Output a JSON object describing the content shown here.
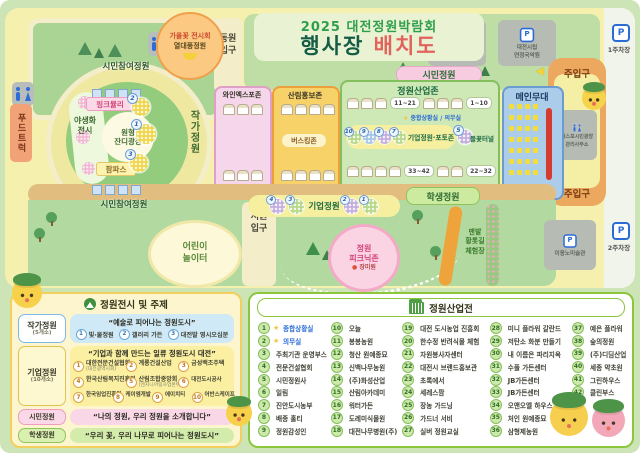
{
  "icons": {
    "parking": "P",
    "star": "★",
    "arrow_left": "◀",
    "dot": "●"
  },
  "title": {
    "line1": "2025 대전정원박람회",
    "line2a": "행사장",
    "line2b": "배치도"
  },
  "badge": {
    "line1": "가을꽃 전시회",
    "line2": "열대풍정원"
  },
  "gates": {
    "east1": "동원",
    "east2": "입구",
    "west1": "서원",
    "west2": "입구"
  },
  "facilities": {
    "arboretum1": "한밭수목원",
    "arboretum2": "종합안내센터",
    "gugak1": "대전시립",
    "gugak2": "연정국악원",
    "office1": "엑스포시민광장",
    "office2": "관리사무소",
    "museum": "이응노미술관",
    "parking1": "1주차장",
    "parking2": "2주차장",
    "food_truck": "푸드트럭"
  },
  "map_labels": {
    "citizen_garden": "시민정원",
    "entrance_top": "주입구",
    "entrance_bottom": "주입구",
    "participation_top": "시민참여정원",
    "participation_bottom": "시민참여정원",
    "pink_muhly": "핑크뮬리",
    "pampas": "팜파스",
    "wildflower1": "야생화",
    "wildflower2": "전시",
    "lawn1": "원형",
    "lawn2": "잔디광장",
    "artist_garden": "작가정원",
    "playground1": "어린이",
    "playground2": "놀이터",
    "corporate_garden": "기업정원",
    "student_garden": "학생정원",
    "picnic1": "정원",
    "picnic2": "피크닉존",
    "picnic3": "장미원",
    "barefoot1": "맨발",
    "barefoot2": "황톳길",
    "barefoot3": "체험장"
  },
  "zones": {
    "wine": "와인엑스포존",
    "forest": "산림홍보존",
    "busking": "버스킹존",
    "industry": "정원산업존",
    "stage": "메인무대",
    "range_tl": "11~21",
    "range_tr": "1~10",
    "range_bl": "33~42",
    "range_br": "22~32",
    "situation": "종합상황실 / 의무실",
    "corp_photo": "기업정원·포토존",
    "tunnel": "들꽃터널"
  },
  "flower_numbers": {
    "ring": [
      "2",
      "1",
      "3"
    ],
    "industry": [
      "10",
      "9",
      "8",
      "7",
      "5"
    ],
    "corp": [
      "4",
      "3",
      "2",
      "1"
    ]
  },
  "legend_left": {
    "header": "정원전시 및 주제",
    "rows": [
      {
        "name": "작가정원",
        "count": "(5개소)",
        "theme": "“예술로 피어나는 정원도시”",
        "items": [
          {
            "num": "1",
            "label": "빛·물정원"
          },
          {
            "num": "2",
            "label": "갤러리 가든"
          },
          {
            "num": "3",
            "label": "대전발 영시오십분"
          }
        ]
      },
      {
        "name": "기업정원",
        "count": "(10개소)",
        "theme": "“기업과 함께 만드는 일류 정원도시 대전”",
        "items": [
          {
            "num": "1",
            "label": "대한전문건설협회",
            "sub": "(대전광역시회)"
          },
          {
            "num": "2",
            "label": "계룡건설산업"
          },
          {
            "num": "3",
            "label": "금성백조주택"
          },
          {
            "num": "4",
            "label": "한국산림복지진흥원"
          },
          {
            "num": "5",
            "label": "산림조합중앙회",
            "sub": "(엔지니어링사업본부)"
          },
          {
            "num": "6",
            "label": "대전도시공사"
          },
          {
            "num": "7",
            "label": "한국임업진흥원"
          },
          {
            "num": "8",
            "label": "케이엠개발"
          },
          {
            "num": "9",
            "label": "에이치티"
          },
          {
            "num": "10",
            "label": "어반스케이프"
          }
        ]
      },
      {
        "name": "시민정원",
        "count": "(5개소)",
        "theme": "“나의 정원, 우리 정원을 소개합니다”",
        "items": []
      },
      {
        "name": "학생정원",
        "count": "(5개소)",
        "theme": "“우리 꽃, 우리 나무로 피어나는 정원도시”",
        "items": []
      }
    ]
  },
  "legend_right": {
    "header": "정원산업전",
    "columns": [
      [
        {
          "num": "1",
          "label": "종합상황실",
          "star": "★",
          "hl": true
        },
        {
          "num": "2",
          "label": "의무실",
          "star": "★",
          "hl": true
        },
        {
          "num": "3",
          "label": "주최기관 운영부스"
        },
        {
          "num": "4",
          "label": "전문건설협회"
        },
        {
          "num": "5",
          "label": "시민정원사"
        },
        {
          "num": "6",
          "label": "일림"
        },
        {
          "num": "7",
          "label": "진안도시농부"
        },
        {
          "num": "8",
          "label": "배종 홀티"
        },
        {
          "num": "9",
          "label": "정원감성인"
        }
      ],
      [
        {
          "num": "10",
          "label": "오늘"
        },
        {
          "num": "11",
          "label": "봉봉농원"
        },
        {
          "num": "12",
          "label": "청산 원예종묘"
        },
        {
          "num": "13",
          "label": "신백나무농원"
        },
        {
          "num": "14",
          "label": "(주)화성산업"
        },
        {
          "num": "15",
          "label": "산림아카데미"
        },
        {
          "num": "16",
          "label": "워터가든"
        },
        {
          "num": "17",
          "label": "도레미식물원"
        },
        {
          "num": "18",
          "label": "대전나무병원(주)"
        }
      ],
      [
        {
          "num": "19",
          "label": "대전 도시농업 진흥회"
        },
        {
          "num": "20",
          "label": "한수정 반려식물 체험"
        },
        {
          "num": "21",
          "label": "자원봉사자센터"
        },
        {
          "num": "22",
          "label": "대전시 브랜드홍보관"
        },
        {
          "num": "23",
          "label": "초록에서"
        },
        {
          "num": "24",
          "label": "세레스팜"
        },
        {
          "num": "25",
          "label": "장농 가드닝"
        },
        {
          "num": "26",
          "label": "가드너 서비"
        },
        {
          "num": "27",
          "label": "실버 정원교실"
        }
      ],
      [
        {
          "num": "28",
          "label": "미니 플라워 갈란드"
        },
        {
          "num": "29",
          "label": "저탄소 화분 만들기"
        },
        {
          "num": "30",
          "label": "내 이름은 파리지옥"
        },
        {
          "num": "31",
          "label": "수풀 가든센터"
        },
        {
          "num": "32",
          "label": "JB가든센터"
        },
        {
          "num": "33",
          "label": "JB가든센터"
        },
        {
          "num": "34",
          "label": "오앤오엘 하우스"
        },
        {
          "num": "35",
          "label": "처인 원예종묘"
        },
        {
          "num": "36",
          "label": "삼형제농원"
        }
      ],
      [
        {
          "num": "37",
          "label": "예은 플라워"
        },
        {
          "num": "38",
          "label": "숲의정원"
        },
        {
          "num": "39",
          "label": "(주)디딤산업"
        },
        {
          "num": "40",
          "label": "세종 약초원"
        },
        {
          "num": "41",
          "label": "그린하우스"
        },
        {
          "num": "42",
          "label": "클린부스"
        }
      ]
    ]
  }
}
